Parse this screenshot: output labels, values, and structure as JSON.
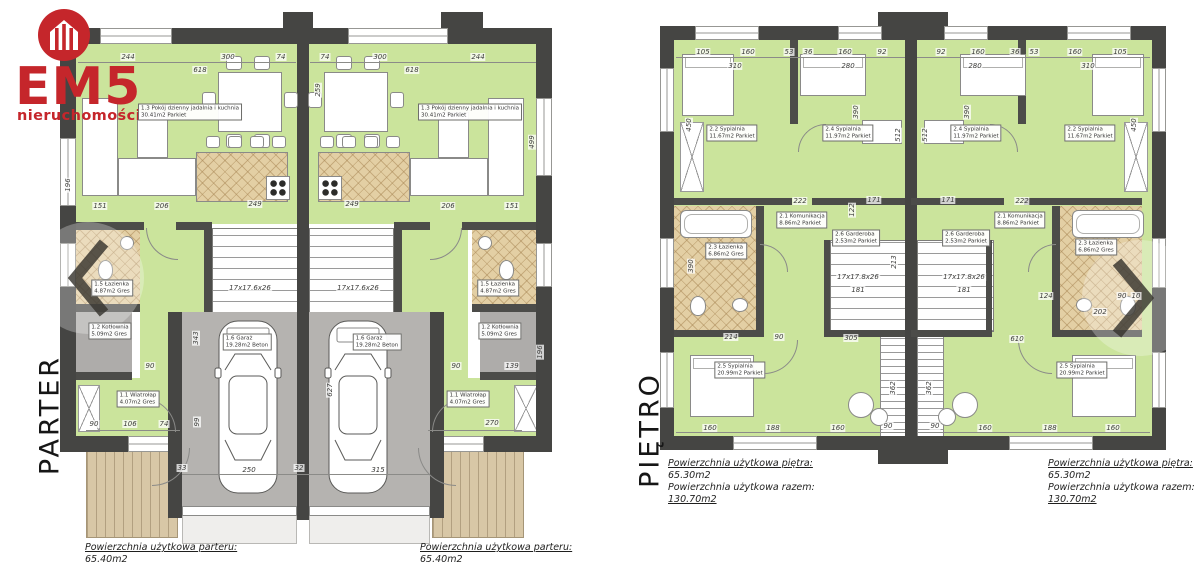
{
  "logo": {
    "brand": "EM5",
    "subtitle": "nieruchomości",
    "accent": "#c5262b",
    "icon": "house-icon"
  },
  "nav": {
    "prev": "chevron-left",
    "next": "chevron-right"
  },
  "plans": {
    "parter": {
      "label": "PARTER"
    },
    "pietro": {
      "label": "PIĘTRO"
    }
  },
  "colors": {
    "wall": "#454543",
    "floor_green": "#cbe49c",
    "tile_tan": "#e3cfa4",
    "garage_gray": "#b5b3b0",
    "terrace_wood": "#d8c7a6",
    "accent_red": "#c5262b"
  },
  "annotations": {
    "dims": [
      {
        "t": "244",
        "x": 128,
        "y": 57
      },
      {
        "t": "300",
        "x": 228,
        "y": 57
      },
      {
        "t": "74",
        "x": 281,
        "y": 57
      },
      {
        "t": "618",
        "x": 200,
        "y": 70
      },
      {
        "t": "74",
        "x": 325,
        "y": 57
      },
      {
        "t": "300",
        "x": 380,
        "y": 57
      },
      {
        "t": "244",
        "x": 478,
        "y": 57
      },
      {
        "t": "618",
        "x": 412,
        "y": 70
      },
      {
        "t": "259",
        "x": 318,
        "y": 90,
        "rot": 1
      },
      {
        "t": "196",
        "x": 68,
        "y": 185,
        "rot": 1
      },
      {
        "t": "499",
        "x": 532,
        "y": 142,
        "rot": 1
      },
      {
        "t": "151",
        "x": 100,
        "y": 206
      },
      {
        "t": "206",
        "x": 162,
        "y": 206
      },
      {
        "t": "249",
        "x": 255,
        "y": 204
      },
      {
        "t": "249",
        "x": 352,
        "y": 204
      },
      {
        "t": "206",
        "x": 448,
        "y": 206
      },
      {
        "t": "151",
        "x": 512,
        "y": 206
      },
      {
        "t": "17x17.6x26",
        "x": 250,
        "y": 288
      },
      {
        "t": "17x17.6x26",
        "x": 358,
        "y": 288
      },
      {
        "t": "90",
        "x": 94,
        "y": 424
      },
      {
        "t": "106",
        "x": 130,
        "y": 424
      },
      {
        "t": "74",
        "x": 164,
        "y": 424
      },
      {
        "t": "270",
        "x": 492,
        "y": 423
      },
      {
        "t": "90",
        "x": 456,
        "y": 366
      },
      {
        "t": "139",
        "x": 512,
        "y": 366
      },
      {
        "t": "90",
        "x": 150,
        "y": 366
      },
      {
        "t": "343",
        "x": 196,
        "y": 338,
        "rot": 1
      },
      {
        "t": "627",
        "x": 330,
        "y": 390,
        "rot": 1
      },
      {
        "t": "99",
        "x": 197,
        "y": 422,
        "rot": 1
      },
      {
        "t": "196",
        "x": 540,
        "y": 352,
        "rot": 1
      },
      {
        "t": "250",
        "x": 249,
        "y": 470
      },
      {
        "t": "315",
        "x": 378,
        "y": 470
      },
      {
        "t": "33",
        "x": 182,
        "y": 468
      },
      {
        "t": "32",
        "x": 299,
        "y": 468
      },
      {
        "t": "105",
        "x": 703,
        "y": 52
      },
      {
        "t": "160",
        "x": 748,
        "y": 52
      },
      {
        "t": "53",
        "x": 789,
        "y": 52
      },
      {
        "t": "36",
        "x": 808,
        "y": 52
      },
      {
        "t": "160",
        "x": 845,
        "y": 52
      },
      {
        "t": "92",
        "x": 882,
        "y": 52
      },
      {
        "t": "92",
        "x": 941,
        "y": 52
      },
      {
        "t": "160",
        "x": 978,
        "y": 52
      },
      {
        "t": "36",
        "x": 1015,
        "y": 52
      },
      {
        "t": "53",
        "x": 1034,
        "y": 52
      },
      {
        "t": "160",
        "x": 1075,
        "y": 52
      },
      {
        "t": "105",
        "x": 1120,
        "y": 52
      },
      {
        "t": "310",
        "x": 735,
        "y": 66
      },
      {
        "t": "280",
        "x": 848,
        "y": 66
      },
      {
        "t": "280",
        "x": 975,
        "y": 66
      },
      {
        "t": "310",
        "x": 1088,
        "y": 66
      },
      {
        "t": "450",
        "x": 689,
        "y": 125,
        "rot": 1
      },
      {
        "t": "390",
        "x": 856,
        "y": 112,
        "rot": 1
      },
      {
        "t": "512",
        "x": 898,
        "y": 135,
        "rot": 1
      },
      {
        "t": "512",
        "x": 925,
        "y": 135,
        "rot": 1
      },
      {
        "t": "390",
        "x": 967,
        "y": 112,
        "rot": 1
      },
      {
        "t": "450",
        "x": 1134,
        "y": 125,
        "rot": 1
      },
      {
        "t": "222",
        "x": 800,
        "y": 201
      },
      {
        "t": "171",
        "x": 874,
        "y": 200
      },
      {
        "t": "122",
        "x": 852,
        "y": 210,
        "rot": 1
      },
      {
        "t": "390",
        "x": 691,
        "y": 266,
        "rot": 1
      },
      {
        "t": "17x17.8x26",
        "x": 858,
        "y": 277
      },
      {
        "t": "181",
        "x": 858,
        "y": 290
      },
      {
        "t": "213",
        "x": 894,
        "y": 262,
        "rot": 1
      },
      {
        "t": "222",
        "x": 1022,
        "y": 201
      },
      {
        "t": "171",
        "x": 948,
        "y": 200
      },
      {
        "t": "17x17.8x26",
        "x": 964,
        "y": 277
      },
      {
        "t": "181",
        "x": 964,
        "y": 290
      },
      {
        "t": "124",
        "x": 1046,
        "y": 296
      },
      {
        "t": "90",
        "x": 1122,
        "y": 296
      },
      {
        "t": "10",
        "x": 1136,
        "y": 296
      },
      {
        "t": "202",
        "x": 1100,
        "y": 312
      },
      {
        "t": "214",
        "x": 731,
        "y": 337
      },
      {
        "t": "90",
        "x": 779,
        "y": 337
      },
      {
        "t": "305",
        "x": 851,
        "y": 338
      },
      {
        "t": "610",
        "x": 1017,
        "y": 339
      },
      {
        "t": "160",
        "x": 710,
        "y": 428
      },
      {
        "t": "188",
        "x": 773,
        "y": 428
      },
      {
        "t": "160",
        "x": 838,
        "y": 428
      },
      {
        "t": "90",
        "x": 888,
        "y": 426
      },
      {
        "t": "90",
        "x": 935,
        "y": 426
      },
      {
        "t": "160",
        "x": 985,
        "y": 428
      },
      {
        "t": "188",
        "x": 1050,
        "y": 428
      },
      {
        "t": "160",
        "x": 1113,
        "y": 428
      },
      {
        "t": "362",
        "x": 893,
        "y": 388,
        "rot": 1
      },
      {
        "t": "362",
        "x": 929,
        "y": 388,
        "rot": 1
      }
    ],
    "rooms": [
      {
        "name": "1.3 Pokój dzienny jadalnia i kuchnia",
        "info": "30.41m2  Parkiet",
        "x": 190,
        "y": 112
      },
      {
        "name": "1.3 Pokój dzienny jadalnia i kuchnia",
        "info": "30.41m2  Parkiet",
        "x": 470,
        "y": 112
      },
      {
        "name": "1.5 Łazienka",
        "info": "4.87m2  Gres",
        "x": 112,
        "y": 288
      },
      {
        "name": "1.5 Łazienka",
        "info": "4.87m2  Gres",
        "x": 498,
        "y": 288
      },
      {
        "name": "1.2 Kotłownia",
        "info": "5.09m2  Gres",
        "x": 110,
        "y": 331
      },
      {
        "name": "1.2 Kotłownia",
        "info": "5.09m2  Gres",
        "x": 500,
        "y": 331
      },
      {
        "name": "1.1 Wiatrołap",
        "info": "4.07m2  Gres",
        "x": 138,
        "y": 399
      },
      {
        "name": "1.1 Wiatrołap",
        "info": "4.07m2  Gres",
        "x": 468,
        "y": 399
      },
      {
        "name": "1.6 Garaż",
        "info": "19.28m2  Beton",
        "x": 247,
        "y": 342
      },
      {
        "name": "1.6 Garaż",
        "info": "19.28m2  Beton",
        "x": 377,
        "y": 342
      },
      {
        "name": "2.2 Sypialnia",
        "info": "11.67m2  Parkiet",
        "x": 732,
        "y": 133
      },
      {
        "name": "2.4 Sypialnia",
        "info": "11.97m2  Parkiet",
        "x": 848,
        "y": 133
      },
      {
        "name": "2.4 Sypialnia",
        "info": "11.97m2  Parkiet",
        "x": 976,
        "y": 133
      },
      {
        "name": "2.2 Sypialnia",
        "info": "11.67m2  Parkiet",
        "x": 1090,
        "y": 133
      },
      {
        "name": "2.1 Komunikacja",
        "info": "8.86m2  Parkiet",
        "x": 802,
        "y": 220
      },
      {
        "name": "2.1 Komunikacja",
        "info": "8.86m2  Parkiet",
        "x": 1020,
        "y": 220
      },
      {
        "name": "2.3 Łazienka",
        "info": "6.86m2  Gres",
        "x": 726,
        "y": 251
      },
      {
        "name": "2.3 Łazienka",
        "info": "6.86m2  Gres",
        "x": 1096,
        "y": 247
      },
      {
        "name": "2.6 Garderoba",
        "info": "2.53m2  Parkiet",
        "x": 856,
        "y": 238
      },
      {
        "name": "2.6 Garderoba",
        "info": "2.53m2  Parkiet",
        "x": 966,
        "y": 238
      },
      {
        "name": "2.5 Sypialnia",
        "info": "20.99m2  Parkiet",
        "x": 740,
        "y": 370
      },
      {
        "name": "2.5 Sypialnia",
        "info": "20.99m2  Parkiet",
        "x": 1082,
        "y": 370
      }
    ],
    "notes": [
      {
        "x": 85,
        "y": 542,
        "lines": [
          {
            "t": "Powierzchnia użytkowa parteru:",
            "u": 1
          },
          {
            "t": "65.40m2"
          }
        ]
      },
      {
        "x": 420,
        "y": 542,
        "lines": [
          {
            "t": "Powierzchnia użytkowa parteru:",
            "u": 1
          },
          {
            "t": "65.40m2"
          }
        ]
      },
      {
        "x": 668,
        "y": 458,
        "lines": [
          {
            "t": "Powierzchnia użytkowa piętra:",
            "u": 1
          },
          {
            "t": "65.30m2"
          },
          {
            "t": "Powierzchnia użytkowa razem:"
          },
          {
            "t": "130.70m2",
            "u": 1
          }
        ]
      },
      {
        "x": 1048,
        "y": 458,
        "lines": [
          {
            "t": "Powierzchnia użytkowa piętra:",
            "u": 1
          },
          {
            "t": "65.30m2"
          },
          {
            "t": "Powierzchnia użytkowa razem:"
          },
          {
            "t": "130.70m2",
            "u": 1
          }
        ]
      }
    ]
  }
}
